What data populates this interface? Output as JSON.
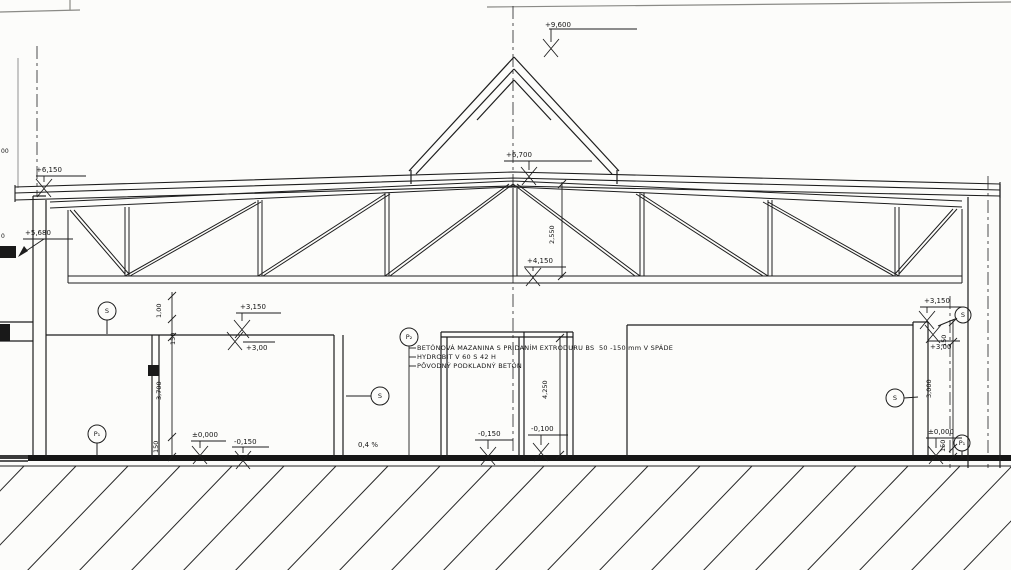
{
  "drawing": {
    "levels": {
      "apex": "+9,600",
      "ridge": "+6,700",
      "eave_left": "+6,150",
      "ledge_left": "+5,680",
      "bottom_chord": "+4,150",
      "wall_top_left_fin": "+3,150",
      "wall_top_left_raw": "+3,00",
      "wall_top_right_fin": "+3,150",
      "wall_top_right_raw": "+3,00",
      "floor_zero_left": "±0,000",
      "floor_minus150_left": "-0,150",
      "floor_minus150_mid": "-0,150",
      "floor_minus100_mid": "-0,100",
      "floor_zero_right": "±0,000"
    },
    "dimensions": {
      "parapet_left": "1,00",
      "step_left_top": "150",
      "room_height_left": "3,700",
      "step_left_bottom": "150",
      "truss_height": "2,550",
      "hall_height_mid": "4,250",
      "step_right_top": "150",
      "room_height_right": "3,000",
      "step_right_bottom": "150",
      "slope": "0,4 %"
    },
    "notes": {
      "line1": "BETÓNOVÁ MAZANINA S PRIDANÍM EXTRODURU BS  50 -150 mm V SPÁDE",
      "line2": "HYDROBIT V 60 S 42 H",
      "line3": "PÔVODNÝ PODKLADNÝ BETÓN"
    },
    "markers": {
      "s_left": "S",
      "s_mid": "S",
      "s_right_wall": "S",
      "s_right_top": "S",
      "p1_left": "P₁",
      "p2_center": "P₂",
      "p1_right": "P₁"
    },
    "partials": {
      "edge_top": "00",
      "edge_mid": "0"
    }
  }
}
